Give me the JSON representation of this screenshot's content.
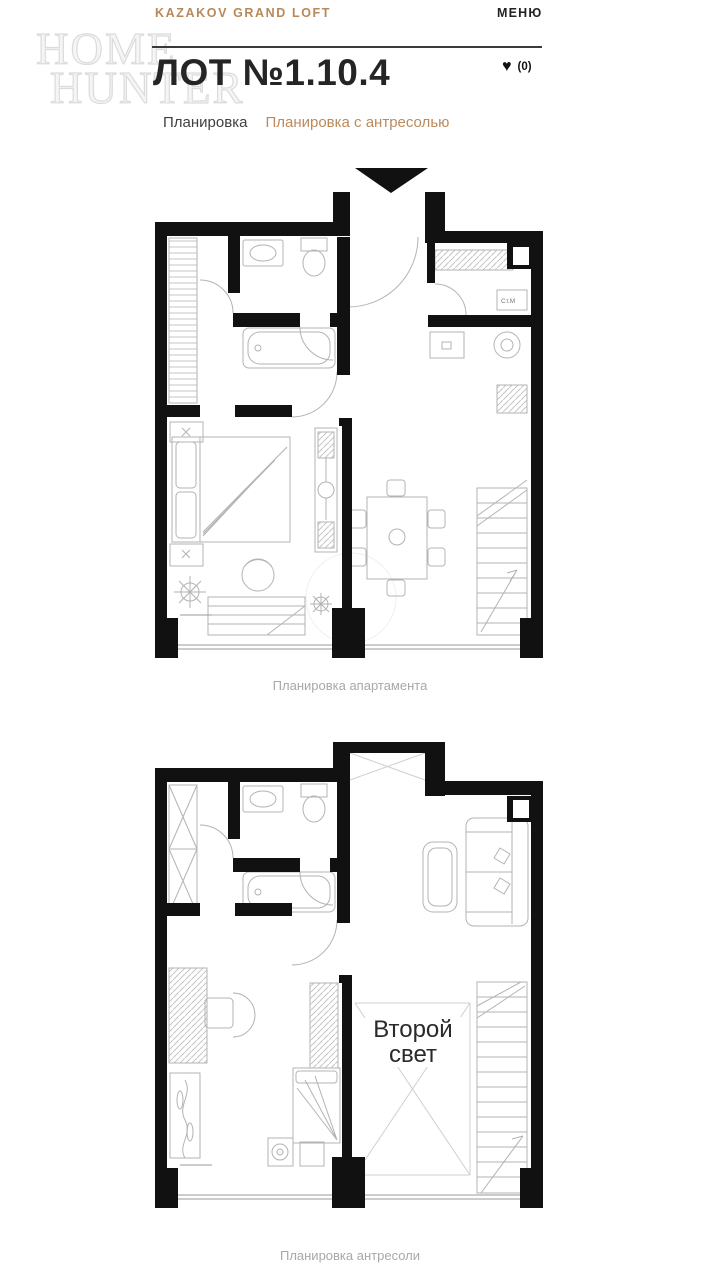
{
  "header": {
    "brand": "KAZAKOV GRAND LOFT",
    "menu": "МЕНЮ"
  },
  "title": {
    "lot": "ЛОТ №1.10.4",
    "favorites_icon": "♥",
    "favorites_count": "(0)"
  },
  "tabs": [
    {
      "label": "Планировка",
      "active": false
    },
    {
      "label": "Планировка с антресолью",
      "active": true
    }
  ],
  "watermark": {
    "line1": "HOME",
    "line2": "HUNTER"
  },
  "plan1": {
    "caption": "Планировка апартамента",
    "washer_label": "Ст.М",
    "entry_marker": "down-triangle"
  },
  "plan2": {
    "caption": "Планировка антресоли",
    "void_line1": "Второй",
    "void_line2": "свет"
  },
  "colors": {
    "accent": "#bc8a5c",
    "ink": "#252525",
    "wall": "#111111",
    "furniture_line": "#b3b3b3",
    "caption_gray": "#a8a8a8"
  }
}
